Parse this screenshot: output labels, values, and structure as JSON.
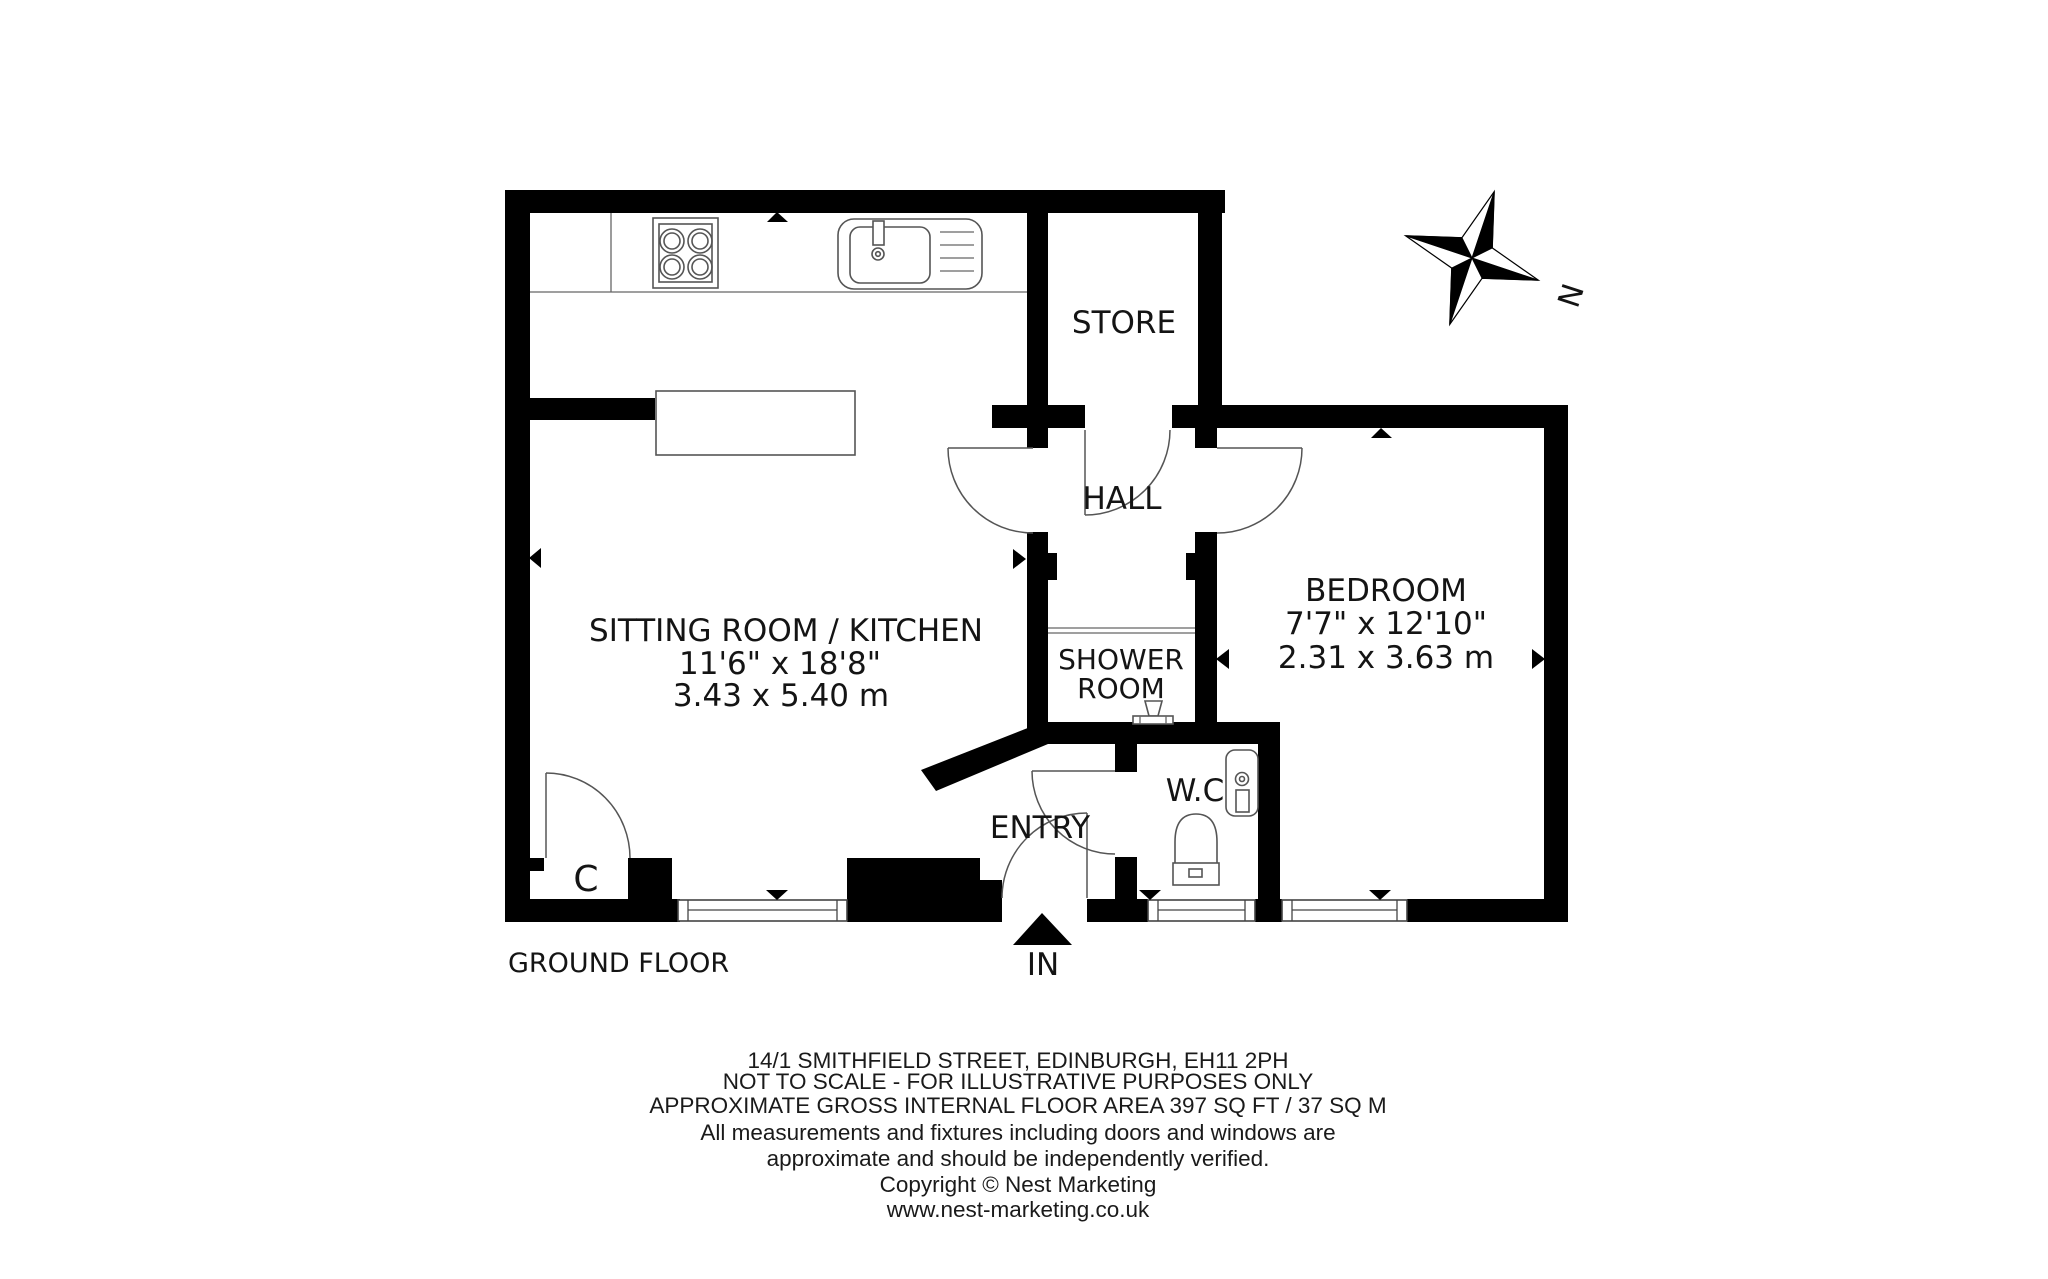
{
  "plan": {
    "rooms": {
      "sitting": {
        "name": "SITTING ROOM / KITCHEN",
        "dims_imperial": "11'6\" x 18'8\"",
        "dims_metric": "3.43 x 5.40 m"
      },
      "bedroom": {
        "name": "BEDROOM",
        "dims_imperial": "7'7\" x 12'10\"",
        "dims_metric": "2.31 x 3.63 m"
      },
      "store": {
        "name": "STORE"
      },
      "hall": {
        "name": "HALL"
      },
      "shower": {
        "line1": "SHOWER",
        "line2": "ROOM"
      },
      "wc": {
        "name": "W.C"
      },
      "entry": {
        "name": "ENTRY"
      },
      "cupboard": {
        "name": "C"
      }
    },
    "floor_label": "GROUND FLOOR",
    "entrance_label": "IN",
    "compass_label": "N"
  },
  "footer": {
    "lines": [
      "14/1 SMITHFIELD STREET, EDINBURGH, EH11 2PH",
      "NOT TO SCALE - FOR ILLUSTRATIVE PURPOSES ONLY",
      "APPROXIMATE GROSS INTERNAL FLOOR AREA 397 SQ FT / 37 SQ M",
      "All measurements and fixtures including doors and windows are",
      "approximate and should be independently verified.",
      "Copyright © Nest Marketing",
      "www.nest-marketing.co.uk"
    ]
  },
  "colors": {
    "wall": "#000000",
    "line": "#555555",
    "text": "#141414",
    "background": "#ffffff"
  }
}
